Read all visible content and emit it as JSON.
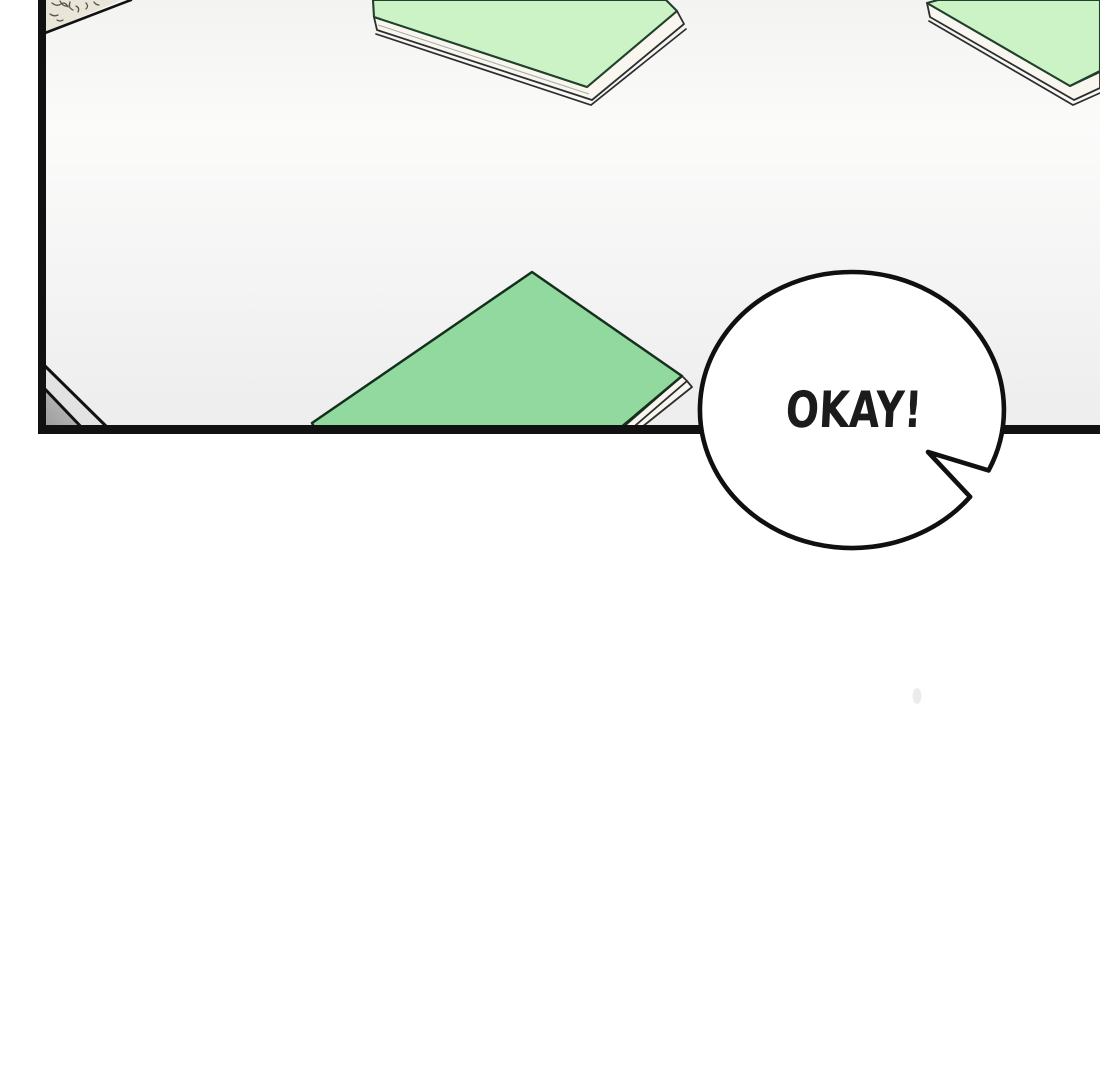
{
  "panel": {
    "speech_bubble": {
      "text": "OKAY!"
    }
  },
  "colors": {
    "panel_bg_top": "#f3f4f2",
    "panel_bg_mid": "#fbfbfa",
    "panel_bg_bottom": "#ededee",
    "ink": "#111111",
    "book_top_green": "#ccf3c6",
    "book_center_green": "#92d9a0",
    "pages": "#f8f6ef",
    "bubble_fill": "#ffffff",
    "speech_text_color": "#1b1b1b",
    "corner_gray_dark": "#9a9a9a",
    "corner_gray_dark_fade": "#c6c6c6",
    "corner_gray_light": "#e2e2e2",
    "texture_beige": "#e9e6d9",
    "smudge_gray": "#dcdcdc",
    "page_margin_bg": "#ffffff"
  }
}
